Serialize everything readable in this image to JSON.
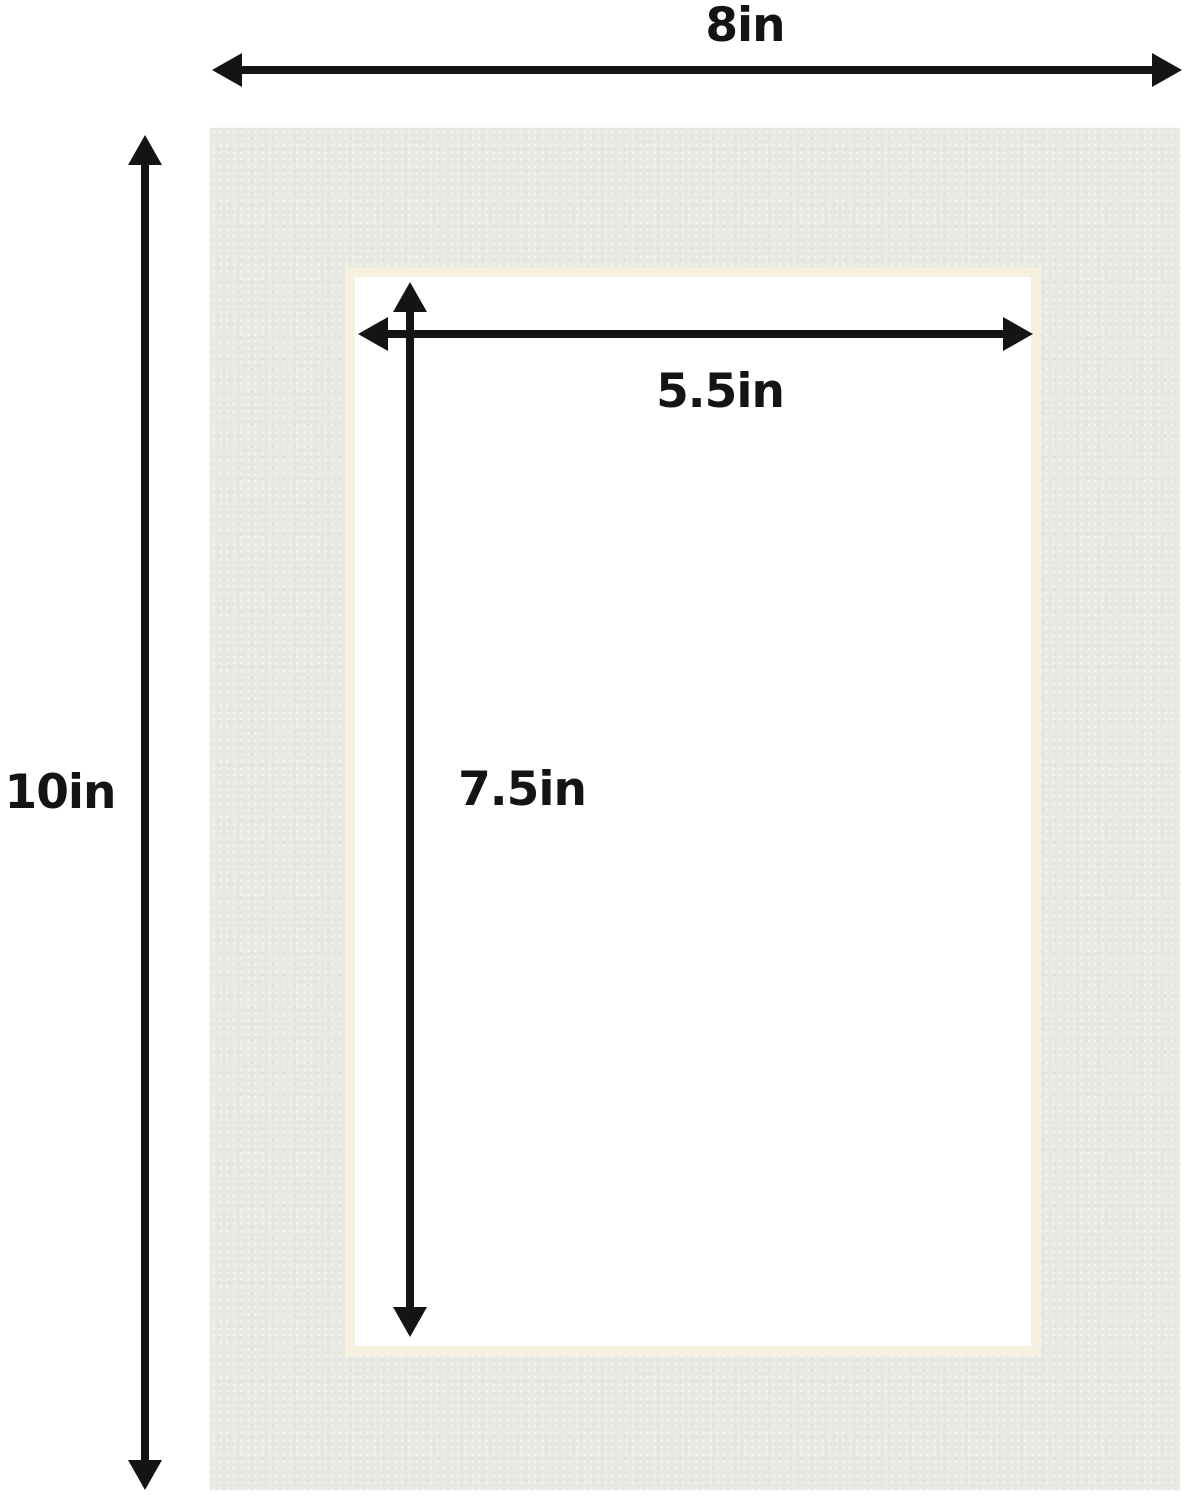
{
  "dimensions": [
    {
      "name": "outer-width",
      "label": "8in"
    },
    {
      "name": "outer-height",
      "label": "10in"
    },
    {
      "name": "window-width",
      "label": "5.5in"
    },
    {
      "name": "window-height",
      "label": "7.5in"
    }
  ],
  "colors": {
    "background": "#ffffff",
    "mat": "#e8e9e2",
    "bevel": "#f6f0df",
    "window": "#ffffff",
    "ink": "#141414"
  }
}
